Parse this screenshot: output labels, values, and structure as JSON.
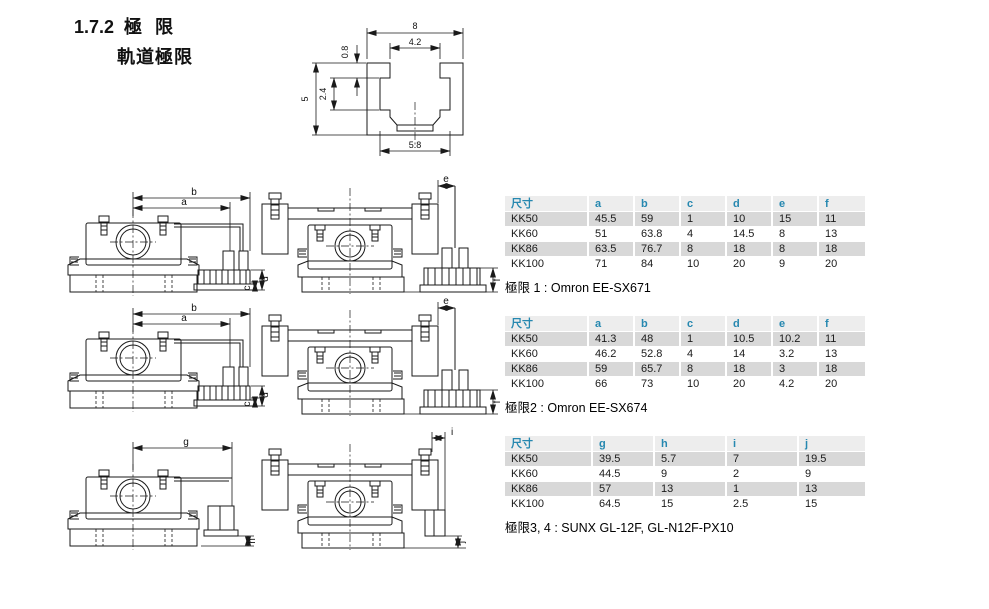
{
  "page": {
    "section_number": "1.7.2",
    "section_title": "極 限",
    "subsection_title": "軌道極限"
  },
  "cross_section": {
    "dims": {
      "overall_width": "8",
      "slot_width": "4.2",
      "lip_depth": "0.8",
      "slot_depth": "2.4",
      "overall_height": "5",
      "base_width": "5.8"
    }
  },
  "drawings": [
    {
      "name": "limit1-front",
      "top_outer": "b",
      "top_inner": "a",
      "right_outer": "d",
      "right_inner": "c"
    },
    {
      "name": "limit1-side",
      "top": "e",
      "right": "f"
    },
    {
      "name": "limit2-front",
      "top_outer": "b",
      "top_inner": "a",
      "right_outer": "d",
      "right_inner": "c"
    },
    {
      "name": "limit2-side",
      "top": "e",
      "right": "f"
    },
    {
      "name": "limit34-front",
      "top": "g",
      "right": "h"
    },
    {
      "name": "limit34-side",
      "top": "i",
      "right": "j"
    }
  ],
  "tables": [
    {
      "caption": "極限 1 : Omron EE-SX671",
      "header": [
        "尺寸",
        "a",
        "b",
        "c",
        "d",
        "e",
        "f"
      ],
      "rows": [
        [
          "KK50",
          "45.5",
          "59",
          "1",
          "10",
          "15",
          "11"
        ],
        [
          "KK60",
          "51",
          "63.8",
          "4",
          "14.5",
          "8",
          "13"
        ],
        [
          "KK86",
          "63.5",
          "76.7",
          "8",
          "18",
          "8",
          "18"
        ],
        [
          "KK100",
          "71",
          "84",
          "10",
          "20",
          "9",
          "20"
        ]
      ]
    },
    {
      "caption": "極限2 : Omron EE-SX674",
      "header": [
        "尺寸",
        "a",
        "b",
        "c",
        "d",
        "e",
        "f"
      ],
      "rows": [
        [
          "KK50",
          "41.3",
          "48",
          "1",
          "10.5",
          "10.2",
          "11"
        ],
        [
          "KK60",
          "46.2",
          "52.8",
          "4",
          "14",
          "3.2",
          "13"
        ],
        [
          "KK86",
          "59",
          "65.7",
          "8",
          "18",
          "3",
          "18"
        ],
        [
          "KK100",
          "66",
          "73",
          "10",
          "20",
          "4.2",
          "20"
        ]
      ]
    },
    {
      "caption": "極限3, 4 : SUNX GL-12F, GL-N12F-PX10",
      "header": [
        "尺寸",
        "g",
        "h",
        "i",
        "j"
      ],
      "rows": [
        [
          "KK50",
          "39.5",
          "5.7",
          "7",
          "19.5"
        ],
        [
          "KK60",
          "44.5",
          "9",
          "2",
          "9"
        ],
        [
          "KK86",
          "57",
          "13",
          "1",
          "13"
        ],
        [
          "KK100",
          "64.5",
          "15",
          "2.5",
          "15"
        ]
      ]
    }
  ],
  "colors": {
    "accent_blue": "#2688b0",
    "row_shade": "#d8d8d8",
    "header_bg": "#ededed",
    "line": "#1a1a1a"
  }
}
